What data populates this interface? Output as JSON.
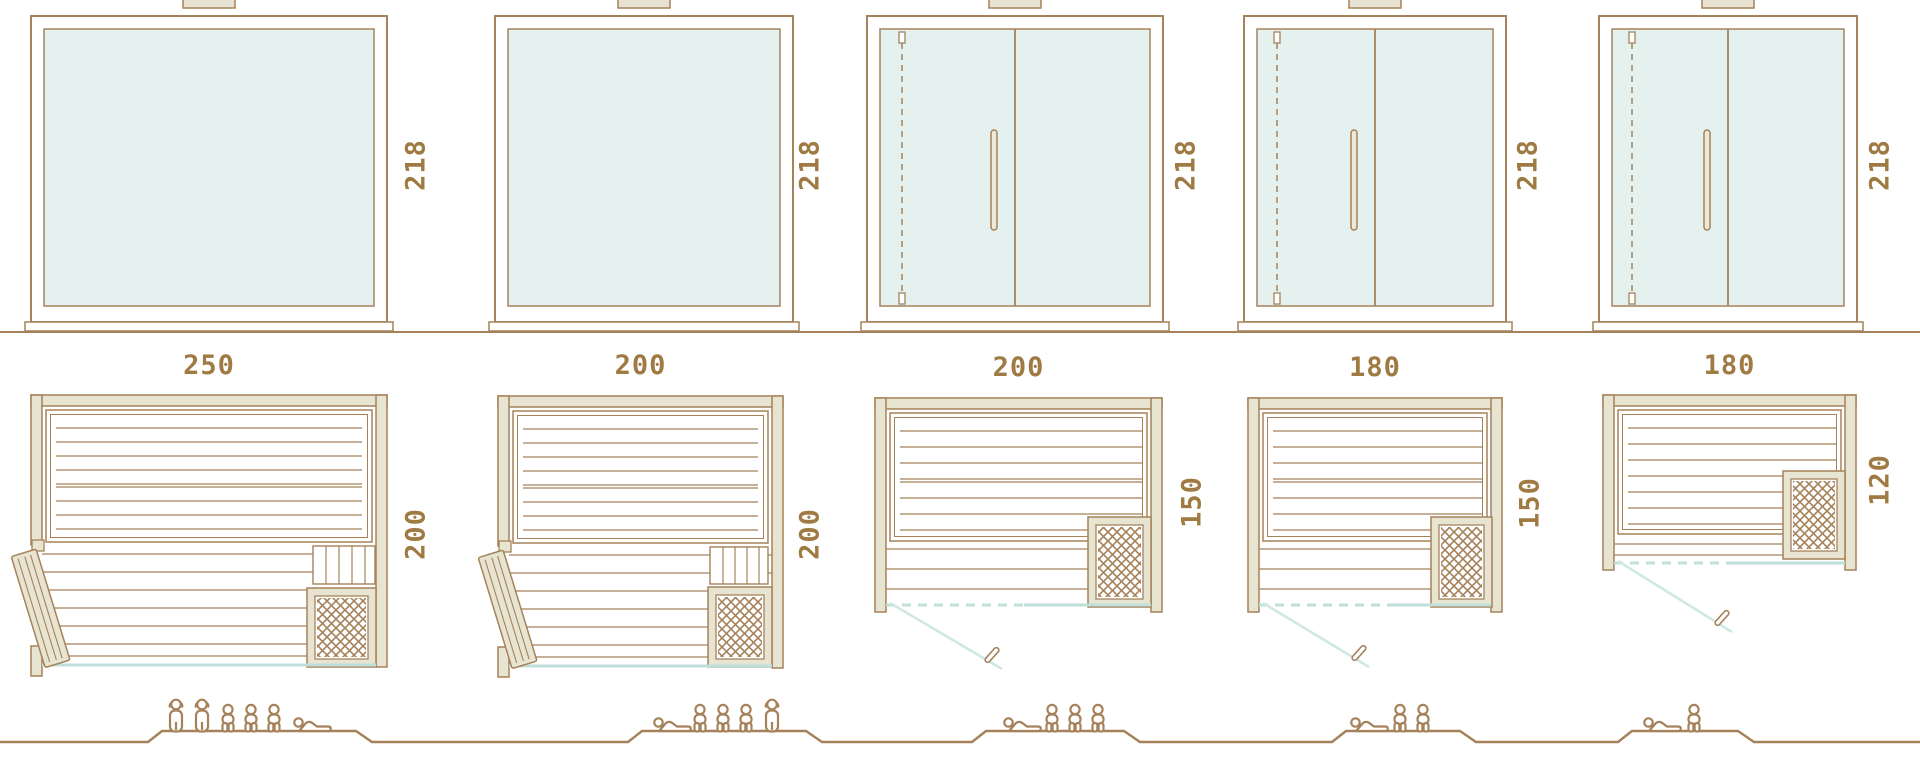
{
  "diagram_title": "sauna-size-comparison",
  "colors": {
    "outline_brown": "#a5825a",
    "wall_fill": "#e7e4d2",
    "glass_fill": "#e4f1ee",
    "glass_line": "#bfe0da",
    "dimension_text": "#9f7a42",
    "background": "#ffffff"
  },
  "units": [
    {
      "id": "unit-1",
      "height_cm": "218",
      "width_cm": "250",
      "depth_cm": "200",
      "front": "fixed-glass",
      "door": "wood-side-door",
      "capacity": {
        "standing": 2,
        "sitting": 3,
        "lying": 1,
        "total": 6
      }
    },
    {
      "id": "unit-2",
      "height_cm": "218",
      "width_cm": "200",
      "depth_cm": "200",
      "front": "fixed-glass",
      "door": "wood-side-door",
      "capacity": {
        "standing": 1,
        "sitting": 3,
        "lying": 1,
        "total": 5
      }
    },
    {
      "id": "unit-3",
      "height_cm": "218",
      "width_cm": "200",
      "depth_cm": "150",
      "front": "glass-double-panel",
      "door": "glass-front-door",
      "capacity": {
        "standing": 0,
        "sitting": 3,
        "lying": 1,
        "total": 4
      }
    },
    {
      "id": "unit-4",
      "height_cm": "218",
      "width_cm": "180",
      "depth_cm": "150",
      "front": "glass-double-panel",
      "door": "glass-front-door",
      "capacity": {
        "standing": 0,
        "sitting": 2,
        "lying": 1,
        "total": 3
      }
    },
    {
      "id": "unit-5",
      "height_cm": "218",
      "width_cm": "180",
      "depth_cm": "120",
      "front": "glass-double-panel",
      "door": "glass-front-door",
      "capacity": {
        "standing": 0,
        "sitting": 1,
        "lying": 1,
        "total": 2
      }
    }
  ]
}
